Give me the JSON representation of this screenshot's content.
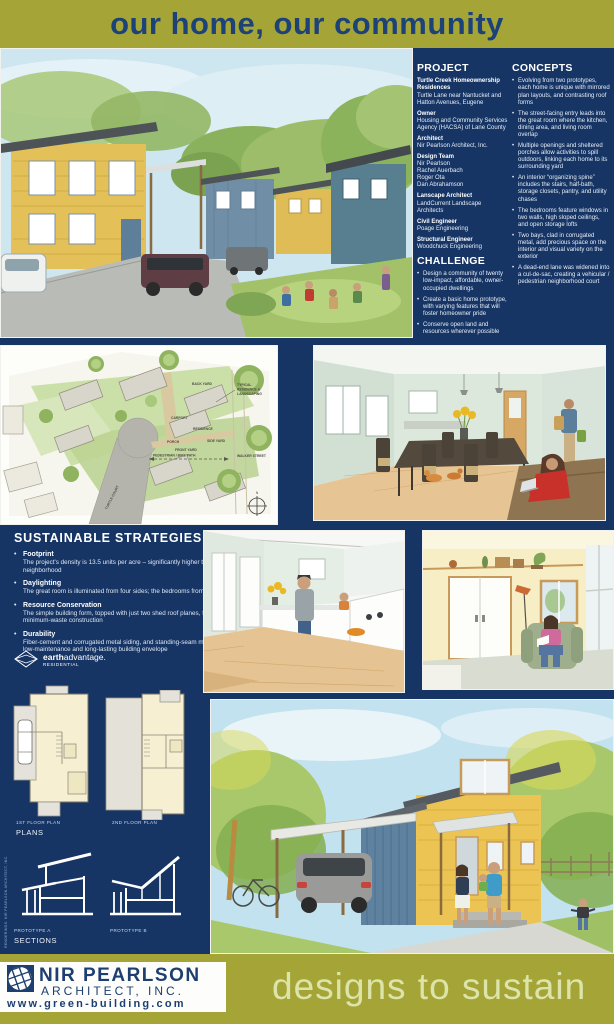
{
  "header": {
    "title": "our home, our community"
  },
  "project": {
    "heading": "PROJECT",
    "blocks": [
      {
        "label": "Turtle Creek Homeownership Residences",
        "text": "Turtle Lane near Nantucket and Hatton Avenues, Eugene"
      },
      {
        "label": "Owner",
        "text": "Housing and Community Services Agency (HACSA) of Lane County"
      },
      {
        "label": "Architect",
        "text": "Nir Pearlson Architect, Inc."
      },
      {
        "label": "Design Team",
        "text": "Nir Pearlson\nRachel Auerbach\nRoger Ota\nDan Abrahamson"
      },
      {
        "label": "Lanscape Architect",
        "text": "LandCurrent Landscape Architects"
      },
      {
        "label": "Civil Engineer",
        "text": "Poage Engineering"
      },
      {
        "label": "Structural Engineer",
        "text": "Woodchuck Engineering"
      }
    ]
  },
  "challenge": {
    "heading": "CHALLENGE",
    "bullets": [
      "Design a community of twenty low-impact, affordable, owner-occupied dwellings",
      "Create a basic home prototype, with varying features that will foster homeowner pride",
      "Conserve open land and resources wherever possible"
    ]
  },
  "concepts": {
    "heading": "CONCEPTS",
    "bullets": [
      "Evolving from two prototypes, each home is unique with mirrored plan layouts, and contrasting roof forms",
      "The street-facing entry leads into the great room where the kitchen, dining area, and living room overlap",
      "Multiple openings and sheltered porches allow activities to spill outdoors, linking each home to its surrounding yard",
      "An interior “organizing spine” includes the stairs, half-bath, storage closets, pantry, and utility chases",
      "The bedrooms feature windows in two walls, high sloped ceilings, and open storage lofts",
      "Two bays, clad in corrugated metal, add precious space on the interior and visual variety on the exterior",
      "A dead-end lane was widened into a cul-de-sac, creating a vehicular / pedestrian neighborhood court"
    ]
  },
  "sustainable": {
    "heading": "SUSTAINABLE STRATEGIES",
    "items": [
      {
        "title": "Footprint",
        "text": "The project's density is 13.5 units per acre – significantly higher than the surrounding neighborhood"
      },
      {
        "title": "Daylighting",
        "text": "The great room is illuminated from four sides; the bedrooms from two to three sides"
      },
      {
        "title": "Resource Conservation",
        "text": "The simple building form, topped with just two shed roof planes, facilitates efficient, minimum-waste construction"
      },
      {
        "title": "Durability",
        "text": "Fiber-cement and corrugated metal siding, and standing-seam metal roofing, make for a low-maintenance and long-lasting building envelope"
      }
    ]
  },
  "earth_advantage": {
    "brand_bold": "earth",
    "brand_rest": "advantage.",
    "sub": "RESIDENTIAL"
  },
  "site_plan": {
    "labels": {
      "back_yard": "BACK YARD",
      "typical_1": "TYPICAL",
      "typical_2": "RESIDENCE &",
      "typical_3": "LANDSCAPING",
      "carport": "CARPORT",
      "residence": "RESIDENCE",
      "porch": "PORCH",
      "side_yard": "SIDE YARD",
      "front_yard": "FRONT YARD",
      "bike_path": "PEDESTRIAN / BIKE PATH",
      "walker_street": "WALKER STREET",
      "turtle_court": "TURTLE COURT",
      "compass": "N"
    }
  },
  "plans": {
    "first": "1ST FLOOR PLAN",
    "second": "2ND FLOOR PLAN",
    "label": "PLANS"
  },
  "sections": {
    "a": "PROTOTYPE A",
    "b": "PROTOTYPE B",
    "label": "SECTIONS"
  },
  "credit": "RENDERINGS: NIR PEARLSON ARCHITECT, INC.",
  "footer": {
    "firm_name": "NIR PEARLSON",
    "firm_suffix": "ARCHITECT, INC.",
    "website": "www.green-building.com",
    "tagline": "designs to sustain"
  },
  "colors": {
    "navy": "#163565",
    "olive": "#a5a437",
    "title_blue": "#1d4278",
    "light_green": "#dde4a9"
  }
}
